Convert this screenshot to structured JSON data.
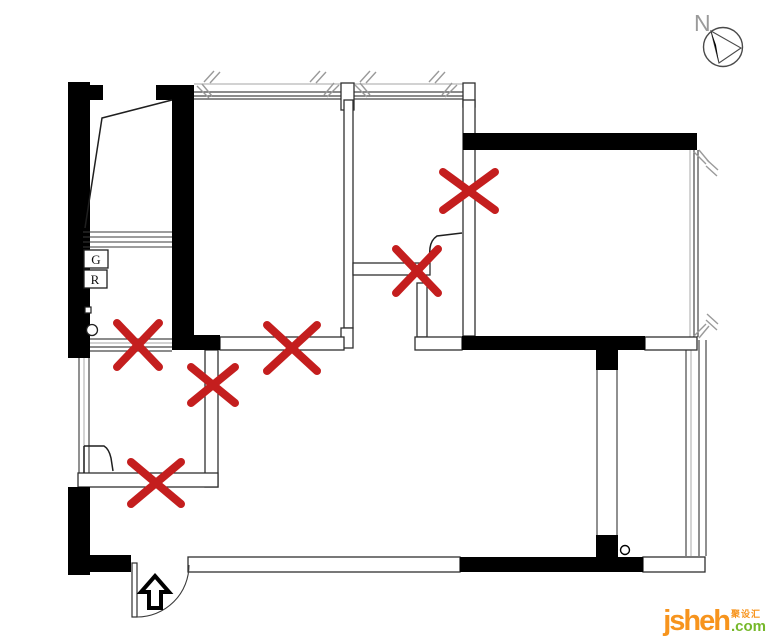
{
  "compass": {
    "label": "N"
  },
  "labels": {
    "gas_meter": "G",
    "water_meter": "R"
  },
  "watermark": {
    "brand": "jsheh",
    "suffix": ".com",
    "tagline_cn": "聚设汇"
  },
  "colors": {
    "wall": "#000000",
    "thin_line": "#3c3c3c",
    "light_line": "#b8b8b8",
    "mark_red": "#c41e1e",
    "logo_orange": "#F7941D",
    "logo_green": "#76B82A",
    "compass_gray": "#9a9a9a"
  },
  "floorplan": {
    "entry_arrow_direction": "up",
    "demolition_marks": [
      {
        "x": 469,
        "y": 191,
        "w": 52,
        "h": 38
      },
      {
        "x": 417,
        "y": 271,
        "w": 42,
        "h": 44
      },
      {
        "x": 138,
        "y": 345,
        "w": 42,
        "h": 44
      },
      {
        "x": 292,
        "y": 348,
        "w": 50,
        "h": 46
      },
      {
        "x": 213,
        "y": 385,
        "w": 44,
        "h": 36
      },
      {
        "x": 156,
        "y": 483,
        "w": 50,
        "h": 42
      }
    ]
  }
}
